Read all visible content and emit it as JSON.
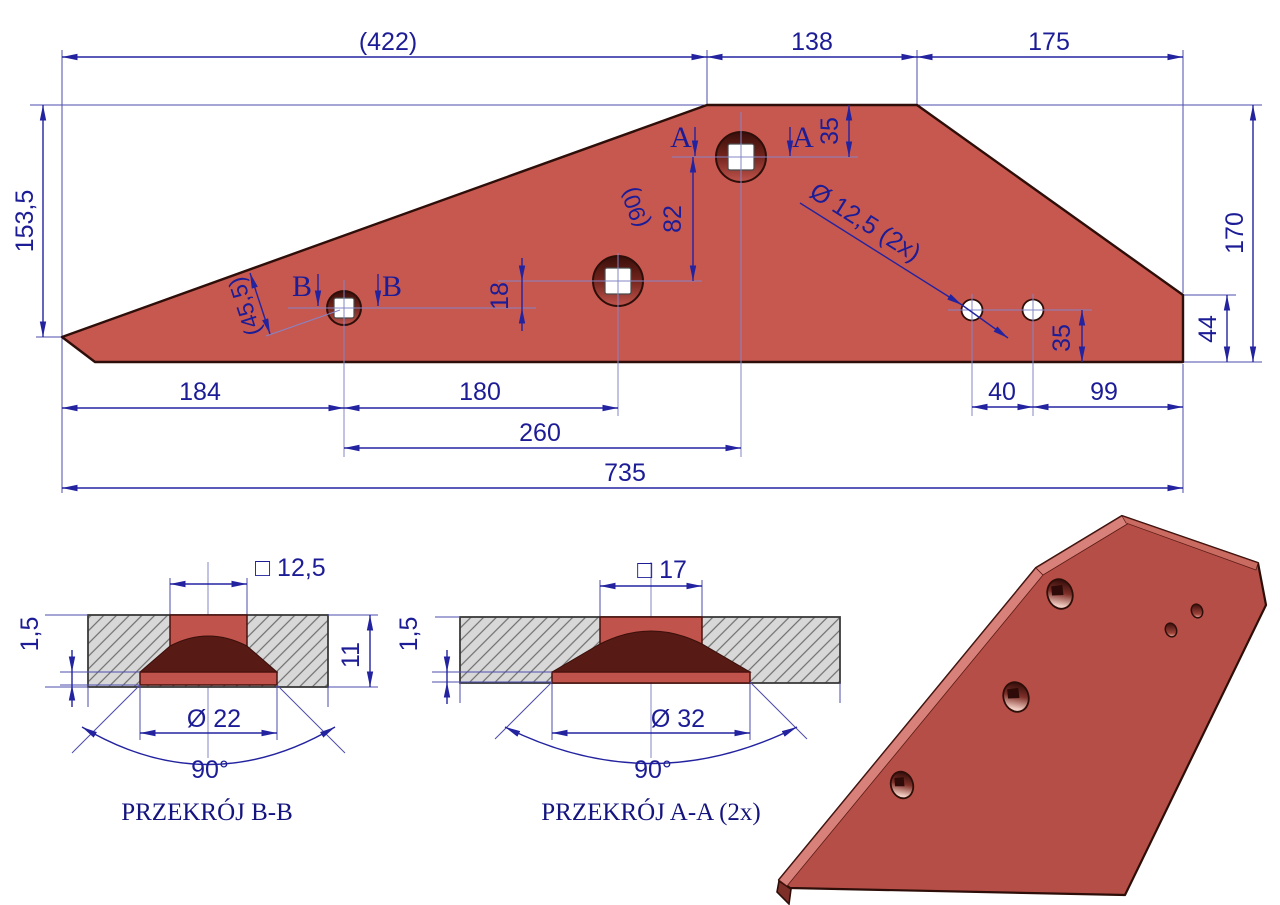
{
  "drawing_title": "Plow wing plate technical drawing",
  "colors": {
    "part_red": "#C75850",
    "part_outline": "#2E0E09",
    "dimension_navy": "#1C1C96",
    "countersink_dark": "#571A14",
    "hatch_gray": "#D8D8D8",
    "iso_red": "#B54E46"
  },
  "main_view": {
    "top_dims": {
      "d422": "(422)",
      "d138": "138",
      "d175": "175"
    },
    "left_dims": {
      "d153_5": "153,5"
    },
    "right_dims": {
      "d170": "170",
      "d44": "44"
    },
    "inner_dims": {
      "d35_top": "35",
      "d82": "82",
      "d18": "18",
      "d90": "(90)",
      "d45_5": "(45,5)",
      "hole_label": "Ø 12,5 (2x)",
      "d35_right": "35"
    },
    "bottom_dims": {
      "d184": "184",
      "d180": "180",
      "d260": "260",
      "d40": "40",
      "d99": "99",
      "d735": "735"
    },
    "section_marks": {
      "a": "A",
      "b": "B"
    }
  },
  "section_b": {
    "title": "PRZEKRÓJ B-B",
    "square": "□ 12,5",
    "lip": "1,5",
    "thickness": "11",
    "diameter": "Ø 22",
    "angle": "90°"
  },
  "section_a": {
    "title": "PRZEKRÓJ A-A (2x)",
    "square": "□ 17",
    "lip": "1,5",
    "diameter": "Ø 32",
    "angle": "90°"
  }
}
